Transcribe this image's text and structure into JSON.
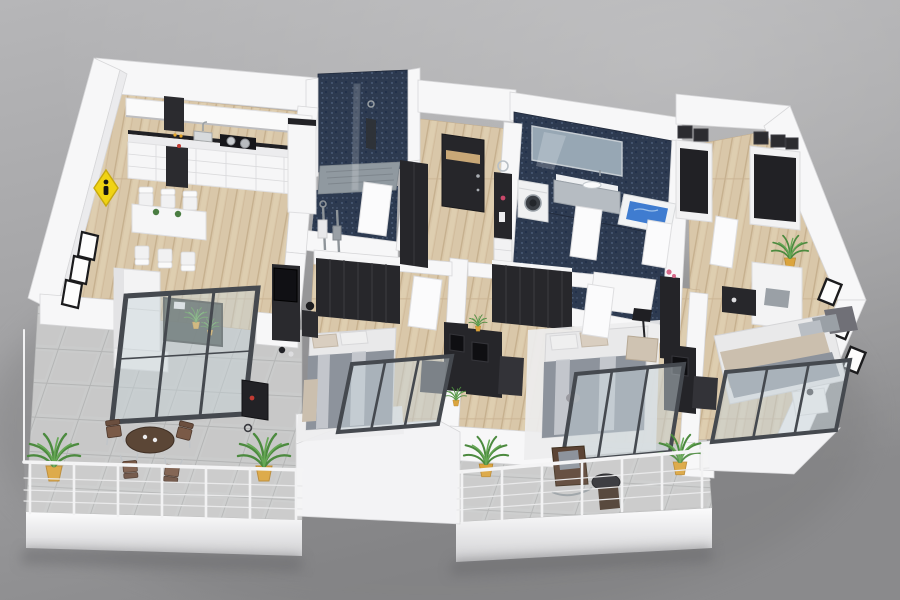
{
  "scene": {
    "description": "3D isometric render of a furnished three-bedroom apartment floor plan on a gray studio background",
    "view": "isometric-top-down",
    "background": "gray-gradient",
    "text_visible": "none"
  },
  "palette": {
    "background_top": "#b4b4b6",
    "background_bottom": "#8a8a8c",
    "wall_white": "#f7f7f8",
    "wall_shade": "#e8e8ea",
    "wood_floor": "#d9c7a9",
    "terrace_tile": "#cacbcb",
    "navy_mosaic": "#2d3a50",
    "furniture_dark": "#26262a",
    "textile_gray": "#8d939c",
    "textile_beige": "#cbbfae",
    "plant_green": "#4c8a3f",
    "pot_yellow": "#dba43d",
    "bath_water_blue": "#3f7cd0",
    "warning_sign_yellow": "#f0d313",
    "window_frame": "#45494f"
  },
  "rooms": [
    {
      "name": "kitchen-dining",
      "floor": "wood",
      "items": [
        "kitchen-cabinet-run",
        "range-hood",
        "cooktop-with-pots",
        "sink",
        "tall-dark-oven-unit",
        "dining-table",
        "six-white-chairs",
        "flower-centerpieces"
      ]
    },
    {
      "name": "living-room",
      "floor": "wood",
      "items": [
        "white-sofa",
        "dark-glass-coffee-table",
        "tv-sideboard",
        "three-wall-frames",
        "sliding-glass-door"
      ]
    },
    {
      "name": "shower-room",
      "floor": "navy-mosaic",
      "items": [
        "walk-in-shower",
        "glass-screen",
        "shower-column",
        "towel-stands",
        "white-door"
      ]
    },
    {
      "name": "entrance-hall",
      "floor": "wood",
      "items": [
        "dark-front-door",
        "dark-wardrobe",
        "console-with-white-drawers",
        "decor-items"
      ]
    },
    {
      "name": "main-bathroom",
      "floor": "navy-mosaic",
      "items": [
        "wall-mirror",
        "floating-vanity-sink",
        "washing-machine",
        "bathtub-with-water",
        "two-white-doors"
      ]
    },
    {
      "name": "walk-in-closet-lounge",
      "floor": "wood",
      "items": [
        "two-shelving-units",
        "black-storage-boxes",
        "white-loveseat",
        "dark-coffee-table",
        "potted-plant",
        "slant-wall-frames"
      ]
    },
    {
      "name": "bedroom-1",
      "floor": "wood",
      "items": [
        "dark-wardrobe",
        "double-bed-gray-blanket",
        "bedside-lamp",
        "desk-with-monitor",
        "office-chair",
        "glass-window"
      ]
    },
    {
      "name": "bedroom-2",
      "floor": "wood",
      "items": [
        "dark-wardrobe",
        "double-bed-on-white-rug",
        "desk-with-monitor",
        "office-chair",
        "floor-lamp",
        "beige-armchair",
        "glass-window",
        "white-door"
      ]
    },
    {
      "name": "bedroom-3",
      "floor": "wood",
      "items": [
        "double-bed-gray-headboard",
        "white-nightstand-lamp",
        "long-dark-desk",
        "office-chair",
        "pink-flowers",
        "glass-window"
      ]
    },
    {
      "name": "terrace",
      "floor": "gray-tile",
      "items": [
        "round-table",
        "four-bistro-chairs",
        "barbecue-grill",
        "two-potted-palms",
        "glass-railing"
      ]
    },
    {
      "name": "balcony",
      "floor": "gray-tile",
      "items": [
        "rocking-chair",
        "side-table",
        "two-potted-palms",
        "glass-railing"
      ]
    }
  ],
  "exterior": {
    "items": [
      "yellow-diamond-warning-sign",
      "white-perimeter-walls",
      "slanted-right-wall",
      "drop-shadow"
    ]
  },
  "counts": {
    "bedrooms": 3,
    "bathrooms": 2,
    "outdoor_areas": 2
  }
}
